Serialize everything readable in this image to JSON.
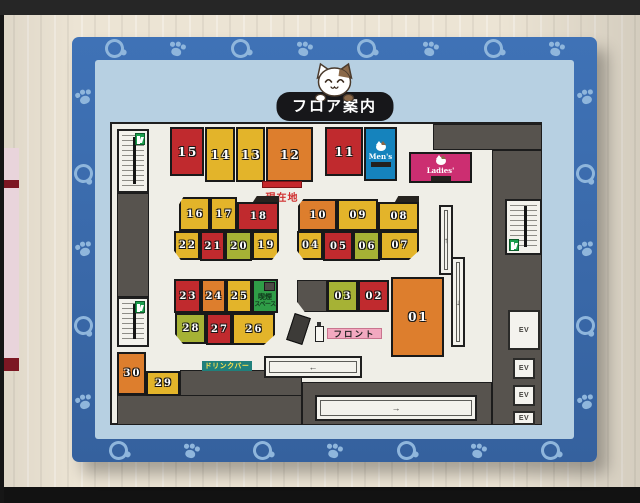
{
  "labels": {
    "title": "フロア案内",
    "current_location": "現在地",
    "front_desk": "フロント",
    "drink_bar": "ドリンクバー",
    "smoking_line1": "喫煙",
    "smoking_line2": "スペース",
    "mens": "Men's",
    "ladies": "Ladies'",
    "ev": "EV"
  },
  "rooms": {
    "r01": "01",
    "r02": "02",
    "r03": "03",
    "r04": "04",
    "r05": "05",
    "r06": "06",
    "r07": "07",
    "r08": "08",
    "r09": "09",
    "r10": "10",
    "r11": "11",
    "r12": "12",
    "r13": "13",
    "r14": "14",
    "r15": "15",
    "r16": "16",
    "r17": "17",
    "r18": "18",
    "r19": "19",
    "r20": "20",
    "r21": "21",
    "r22": "22",
    "r23": "23",
    "r24": "24",
    "r25": "25",
    "r26": "26",
    "r27": "27",
    "r28": "28",
    "r29": "29",
    "r30": "30"
  },
  "room_colors": {
    "r01": "orange",
    "r02": "red",
    "r03": "green",
    "r04": "yellow",
    "r05": "red",
    "r06": "green",
    "r07": "yellow",
    "r08": "yellow",
    "r09": "yellow",
    "r10": "orange",
    "r11": "red",
    "r12": "orange",
    "r13": "yellow",
    "r14": "yellow",
    "r15": "red",
    "r16": "yellow",
    "r17": "yellow",
    "r18": "red",
    "r19": "yellow",
    "r20": "green",
    "r21": "red",
    "r22": "yellow",
    "r23": "red",
    "r24": "orange",
    "r25": "yellow",
    "r26": "yellow",
    "r27": "red",
    "r28": "green",
    "r29": "yellow",
    "r30": "orange"
  },
  "palette": {
    "red": "#c02a2e",
    "yellow": "#e3b42a",
    "orange": "#dd7e2d",
    "green": "#a6b235",
    "smoking_green": "#2f9d47",
    "mens_blue": "#1583bd",
    "ladies_pink": "#cc2e71",
    "wall_gray": "#57534e",
    "floor": "#efeee7",
    "board_frame_blue": "#3a6db3",
    "board_inner_blue": "#b7d0e2",
    "paw_blue": "#8fb6dc",
    "front_label_pink": "#f2a9c0",
    "drink_bar_teal": "#20807c",
    "exit_green": "#1a9e4d",
    "current_location_red": "#d03030"
  },
  "icons": {
    "paw_print": "css-shape",
    "toy_ball": "css-shape",
    "cat_mascot": "inline-svg",
    "cat_face": "css-shape",
    "emergency_exit": "css-shape",
    "escalator_arrows": "← → ↑ ↓",
    "smoking_area_box": "css-shape"
  }
}
